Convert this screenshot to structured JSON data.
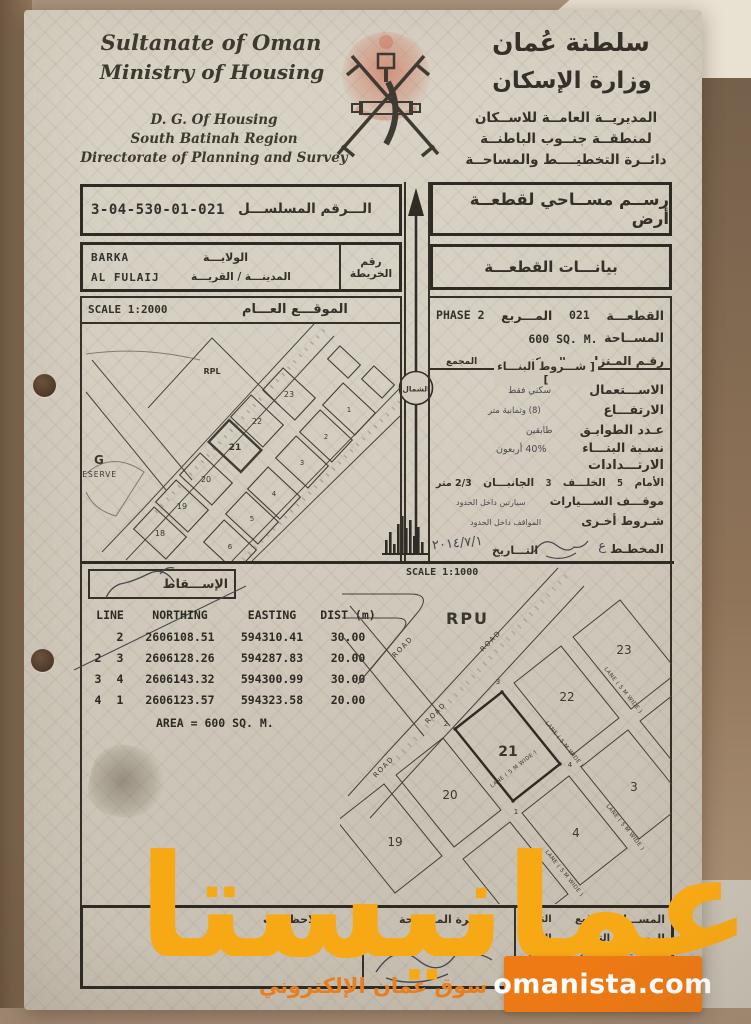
{
  "colors": {
    "watermark_text": "#f7a815",
    "watermark_box": "#ee7a15",
    "paper": "#d2cbbd",
    "ink": "#353129",
    "emblem_red": "#c44b28"
  },
  "header": {
    "country_en": "Sultanate of Oman",
    "ministry_en": "Ministry of Housing",
    "dept_en_1": "D. G. Of Housing",
    "dept_en_2": "South Batinah Region",
    "dept_en_3": "Directorate of Planning and Survey",
    "country_ar": "سلطنة عُمان",
    "ministry_ar": "وزارة الإسكان",
    "dept_ar_1": "المديريــة العامــة للاســكان",
    "dept_ar_2": "لمنطقــة جنــوب الباطنــة",
    "dept_ar_3": "دائــرة التخطيــــط والمساحــة"
  },
  "serial": {
    "label": "الـــرقم المسلســـل",
    "value": "3-04-530-01-021"
  },
  "doc_title": "رســم مســاحي لقطعــة أرض",
  "location": {
    "wilayat_label": "الولايـــة",
    "wilayat": "BARKA",
    "town_label": "المدينـــة / القريـــة",
    "town": "AL FULAIJ",
    "map_no_label": "رقم الخريطة"
  },
  "plot_info_title": "بيانـــات القطعـــة",
  "general_map": {
    "scale": "SCALE 1:2000",
    "title": "الموقـــع العـــام",
    "rpl": "RPL",
    "g": "G",
    "reserve": "RESERVE",
    "row_a": [
      "23",
      "22",
      "21",
      "20",
      "19",
      "18"
    ],
    "row_b": [
      "1",
      "2",
      "3",
      "4",
      "5",
      "6"
    ]
  },
  "north_label": "الشمال",
  "details": {
    "plot_label": "القطعـــة",
    "plot_no": "021",
    "block_label": "المـــربع",
    "block": "PHASE 2",
    "area_label": "المســاحة",
    "area": "600 SQ. M.",
    "house_label": "رقـم المـنزل",
    "street_label": "الســـكة",
    "complex_label": "المجمع",
    "terms_title": "[ شـــروط البنـــاء ]",
    "use_label": "الاســـتعمال",
    "use": "سكني فقط",
    "height_label": "الارتفـــاع",
    "height": "(8) وثمانية متر",
    "floors_label": "عـدد الطوابـق",
    "floors": "طابقين",
    "ratio_label": "نسـبة البنـــاء",
    "ratio": "40% أربعون",
    "setbacks_title": "الارتـــدادات",
    "front_label": "الأمام",
    "front": "5",
    "back_label": "الخلـــف",
    "back": "3",
    "sides_label": "الجانبـــان",
    "sides": "2/3 متر",
    "parking_label": "موقـــف الســـيارات",
    "parking": "سيارتين داخل الحدود",
    "other_label": "شـروط أخـرى",
    "other": "المواقف داخل الحدود",
    "planner_label": "المخطـط",
    "planner_sig": "ع",
    "date_label": "التـــاريخ",
    "date": "٢٠١٤/٧/١"
  },
  "projection_label": "الإســـقاط",
  "site_plan": {
    "scale": "SCALE 1:1000",
    "rpu": "RPU",
    "road": "ROAD",
    "lane": "LANE ( 5 M WIDE )",
    "plots": {
      "p21": "21",
      "p22": "22",
      "p23": "23",
      "p20": "20",
      "p19": "19",
      "p3": "3",
      "p4": "4"
    },
    "corners": [
      "1",
      "2",
      "3",
      "4"
    ]
  },
  "coords": {
    "headers": {
      "line": "LINE",
      "northing": "NORTHING",
      "easting": "EASTING",
      "dist": "DIST (m)"
    },
    "rows": [
      {
        "from": "",
        "to": "2",
        "northing": "2606108.51",
        "easting": "594310.41",
        "dist": "30.00"
      },
      {
        "from": "2",
        "to": "3",
        "northing": "2606128.26",
        "easting": "594287.83",
        "dist": "20.00"
      },
      {
        "from": "3",
        "to": "4",
        "northing": "2606143.32",
        "easting": "594300.99",
        "dist": "30.00"
      },
      {
        "from": "4",
        "to": "1",
        "northing": "2606123.57",
        "easting": "594323.58",
        "dist": "20.00"
      }
    ],
    "area": "AREA = 600 SQ. M."
  },
  "signatures": {
    "notes_label": "الملاحظـــات",
    "dept_label": "دائـرة المســاحة",
    "rows": [
      {
        "role": "المســـاح",
        "sig": "التوقيع",
        "date": "التاريخ"
      },
      {
        "role": "الرســـام",
        "sig": "التوقيع",
        "date": "التاريخ"
      },
      {
        "role": "التـــدقيق",
        "sig": "",
        "date": ""
      },
      {
        "role": "المـــدير",
        "sig": "",
        "date": ""
      }
    ],
    "hand_date": "٢٠١٤/٧/٩"
  },
  "watermark": {
    "brand": "عمانيستا",
    "tagline": "سوق عمان الإلكتروني",
    "website": "omanista.com"
  }
}
